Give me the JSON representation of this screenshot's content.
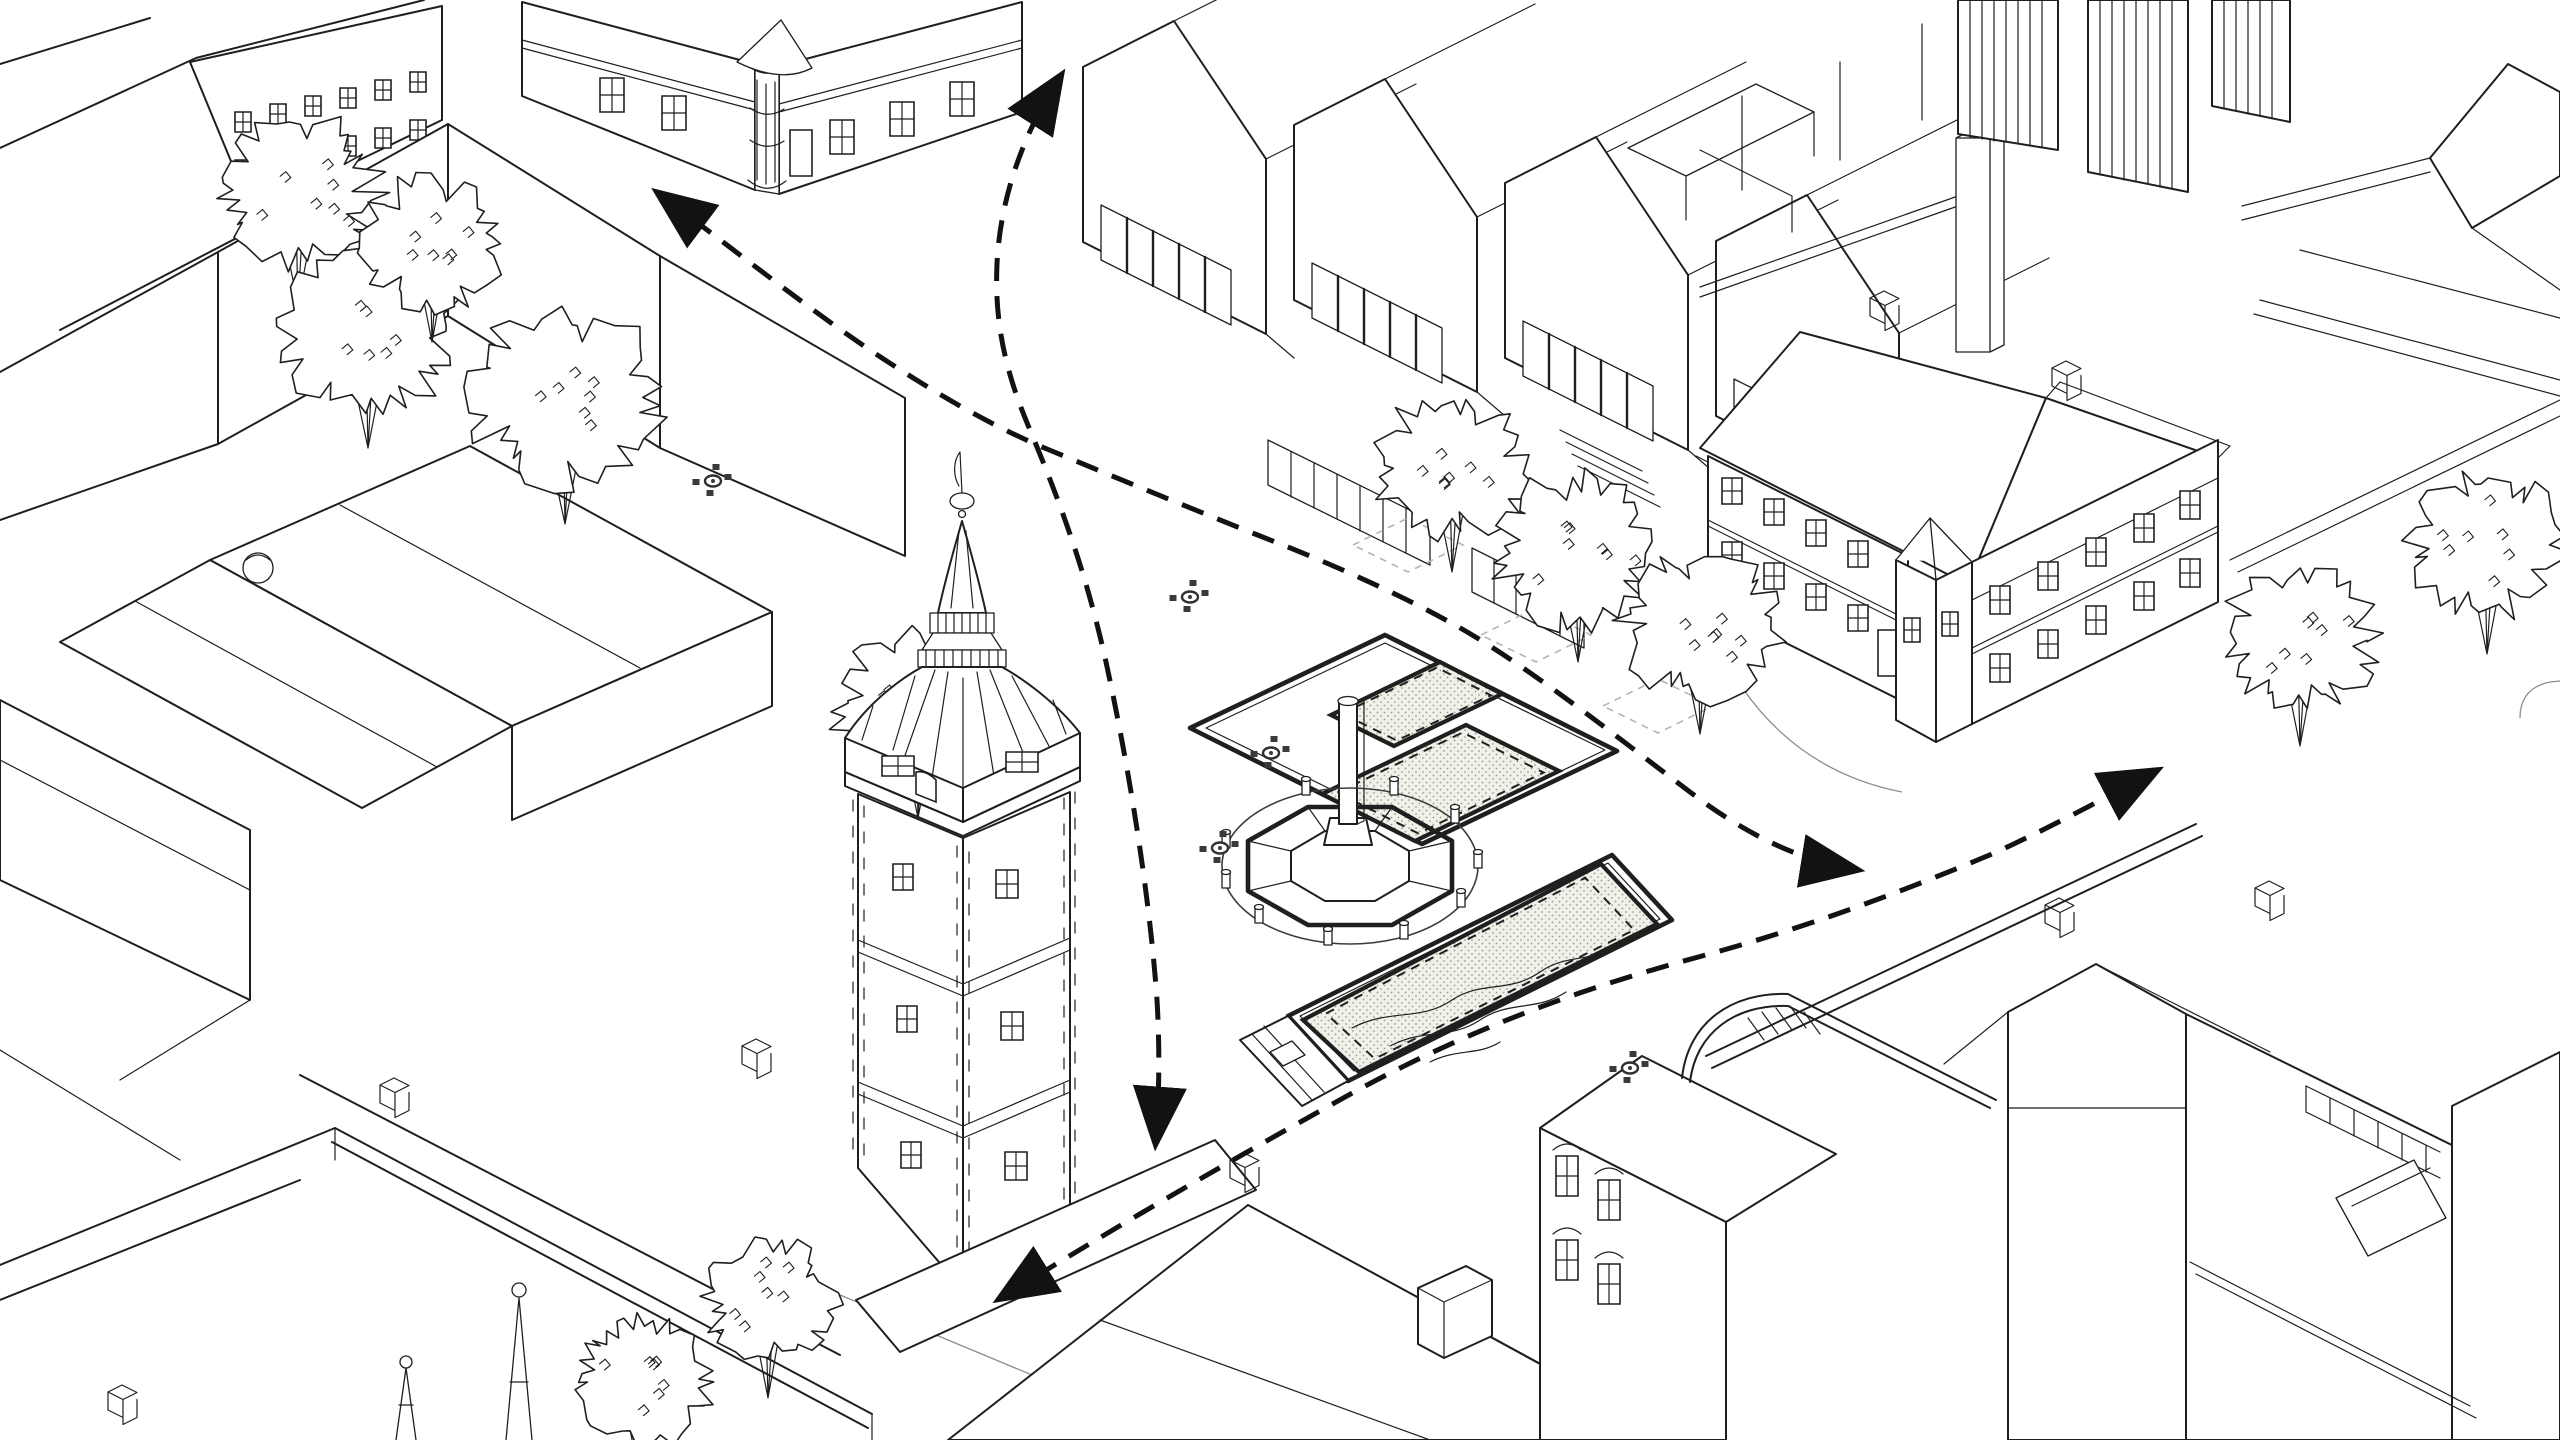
{
  "canvas": {
    "width": 2560,
    "height": 1440
  },
  "colors": {
    "background": "#ffffff",
    "line": "#1f1f1f",
    "flow_arrow": "#121212",
    "stipple_fill": "#f0f1e9",
    "stipple_dot": "#98a08c",
    "tree_pit": "#b4b4b4",
    "table": "#3a3a3a"
  },
  "scene": {
    "kind": "axonometric-urban-line-drawing",
    "subject": "town square with clock tower, plague column monument, planting beds and pedestrian flow arrows",
    "flow_paths": [
      {
        "name": "flow-northwest-diagonal",
        "d": "M662,196 C740,254 812,312 882,358 C940,396 992,426 1047,449 C1117,478 1185,506 1255,534 C1322,560 1392,590 1455,625 C1532,668 1628,746 1702,801 C1756,840 1808,862 1852,869"
      },
      {
        "name": "flow-north-south",
        "d": "M1058,80 C1022,136 1000,200 997,264 C994,328 1008,378 1030,430 C1060,502 1086,572 1106,662 C1130,772 1150,900 1157,1000 C1160,1050 1159,1098 1156,1138"
      },
      {
        "name": "flow-southwest-east",
        "d": "M1004,1296 C1120,1224 1242,1154 1356,1091 C1470,1029 1582,988 1702,956 C1802,929 1902,892 1992,854 C2052,827 2112,794 2152,773"
      }
    ],
    "platforms": [
      {
        "name": "platform-upper",
        "points": [
          [
            1190,
            728
          ],
          [
            1385,
            635
          ],
          [
            1617,
            751
          ],
          [
            1422,
            844
          ]
        ]
      },
      {
        "name": "platform-lower",
        "points": [
          [
            1288,
            1016
          ],
          [
            1612,
            855
          ],
          [
            1672,
            920
          ],
          [
            1348,
            1081
          ]
        ]
      }
    ],
    "planting_beds": [
      {
        "name": "bed-upper-small",
        "points": [
          [
            1331,
            715
          ],
          [
            1440,
            662
          ],
          [
            1502,
            694
          ],
          [
            1394,
            746
          ]
        ]
      },
      {
        "name": "bed-upper-large",
        "points": [
          [
            1322,
            794
          ],
          [
            1466,
            725
          ],
          [
            1559,
            771
          ],
          [
            1415,
            841
          ]
        ]
      },
      {
        "name": "bed-lower-water",
        "points": [
          [
            1303,
            1020
          ],
          [
            1601,
            864
          ],
          [
            1657,
            924
          ],
          [
            1359,
            1072
          ]
        ]
      }
    ],
    "water_lines": [
      "M1352,1028 C1390,1008 1420,1022 1452,1000 C1482,980 1508,994 1540,972 C1566,954 1590,962 1612,948",
      "M1390,1046 C1424,1028 1450,1040 1480,1020 C1510,1000 1536,1012 1566,992",
      "M1430,1062 C1458,1048 1478,1056 1500,1042"
    ],
    "monument": {
      "name": "plague-column",
      "chain": {
        "cx": 1350,
        "cy": 866,
        "rx": 128,
        "ry": 78
      },
      "bollards": [
        [
          1226,
          846
        ],
        [
          1226,
          886
        ],
        [
          1259,
          921
        ],
        [
          1328,
          943
        ],
        [
          1404,
          937
        ],
        [
          1461,
          905
        ],
        [
          1478,
          866
        ],
        [
          1455,
          821
        ],
        [
          1394,
          793
        ],
        [
          1306,
          793
        ]
      ]
    },
    "tree_pits": [
      {
        "cx": 1408,
        "cy": 545,
        "rx": 55,
        "ry": 27
      },
      {
        "cx": 1536,
        "cy": 635,
        "rx": 55,
        "ry": 27
      },
      {
        "cx": 1658,
        "cy": 706,
        "rx": 55,
        "ry": 27
      }
    ],
    "trees": [
      {
        "x": 298,
        "y": 192,
        "r": 86,
        "seed": 3,
        "layer": "trees-back"
      },
      {
        "x": 368,
        "y": 330,
        "r": 92,
        "seed": 7,
        "layer": "trees-back"
      },
      {
        "x": 432,
        "y": 242,
        "r": 74,
        "seed": 11,
        "layer": "trees-back"
      },
      {
        "x": 565,
        "y": 398,
        "r": 100,
        "seed": 5,
        "layer": "trees-back"
      },
      {
        "x": 918,
        "y": 706,
        "r": 86,
        "seed": 13,
        "layer": "trees-back"
      },
      {
        "x": 1452,
        "y": 466,
        "r": 80,
        "seed": 17,
        "layer": "trees-street"
      },
      {
        "x": 1578,
        "y": 550,
        "r": 86,
        "seed": 19,
        "layer": "trees-street"
      },
      {
        "x": 1700,
        "y": 626,
        "r": 82,
        "seed": 23,
        "layer": "trees-street"
      },
      {
        "x": 2300,
        "y": 640,
        "r": 80,
        "seed": 29,
        "layer": "trees-right"
      },
      {
        "x": 2487,
        "y": 546,
        "r": 82,
        "seed": 31,
        "layer": "trees-right"
      },
      {
        "x": 640,
        "y": 1380,
        "r": 74,
        "seed": 37,
        "layer": "trees-front"
      },
      {
        "x": 768,
        "y": 1302,
        "r": 70,
        "seed": 41,
        "layer": "trees-front"
      }
    ],
    "cafe_tables": [
      {
        "x": 713,
        "y": 481
      },
      {
        "x": 1190,
        "y": 597
      },
      {
        "x": 1271,
        "y": 753
      },
      {
        "x": 1220,
        "y": 848
      },
      {
        "x": 1630,
        "y": 1068
      }
    ],
    "modern_bays": [
      {
        "x": 1083,
        "y": 242
      },
      {
        "x": 1294,
        "y": 300
      },
      {
        "x": 1505,
        "y": 358
      },
      {
        "x": 1716,
        "y": 416
      }
    ]
  }
}
